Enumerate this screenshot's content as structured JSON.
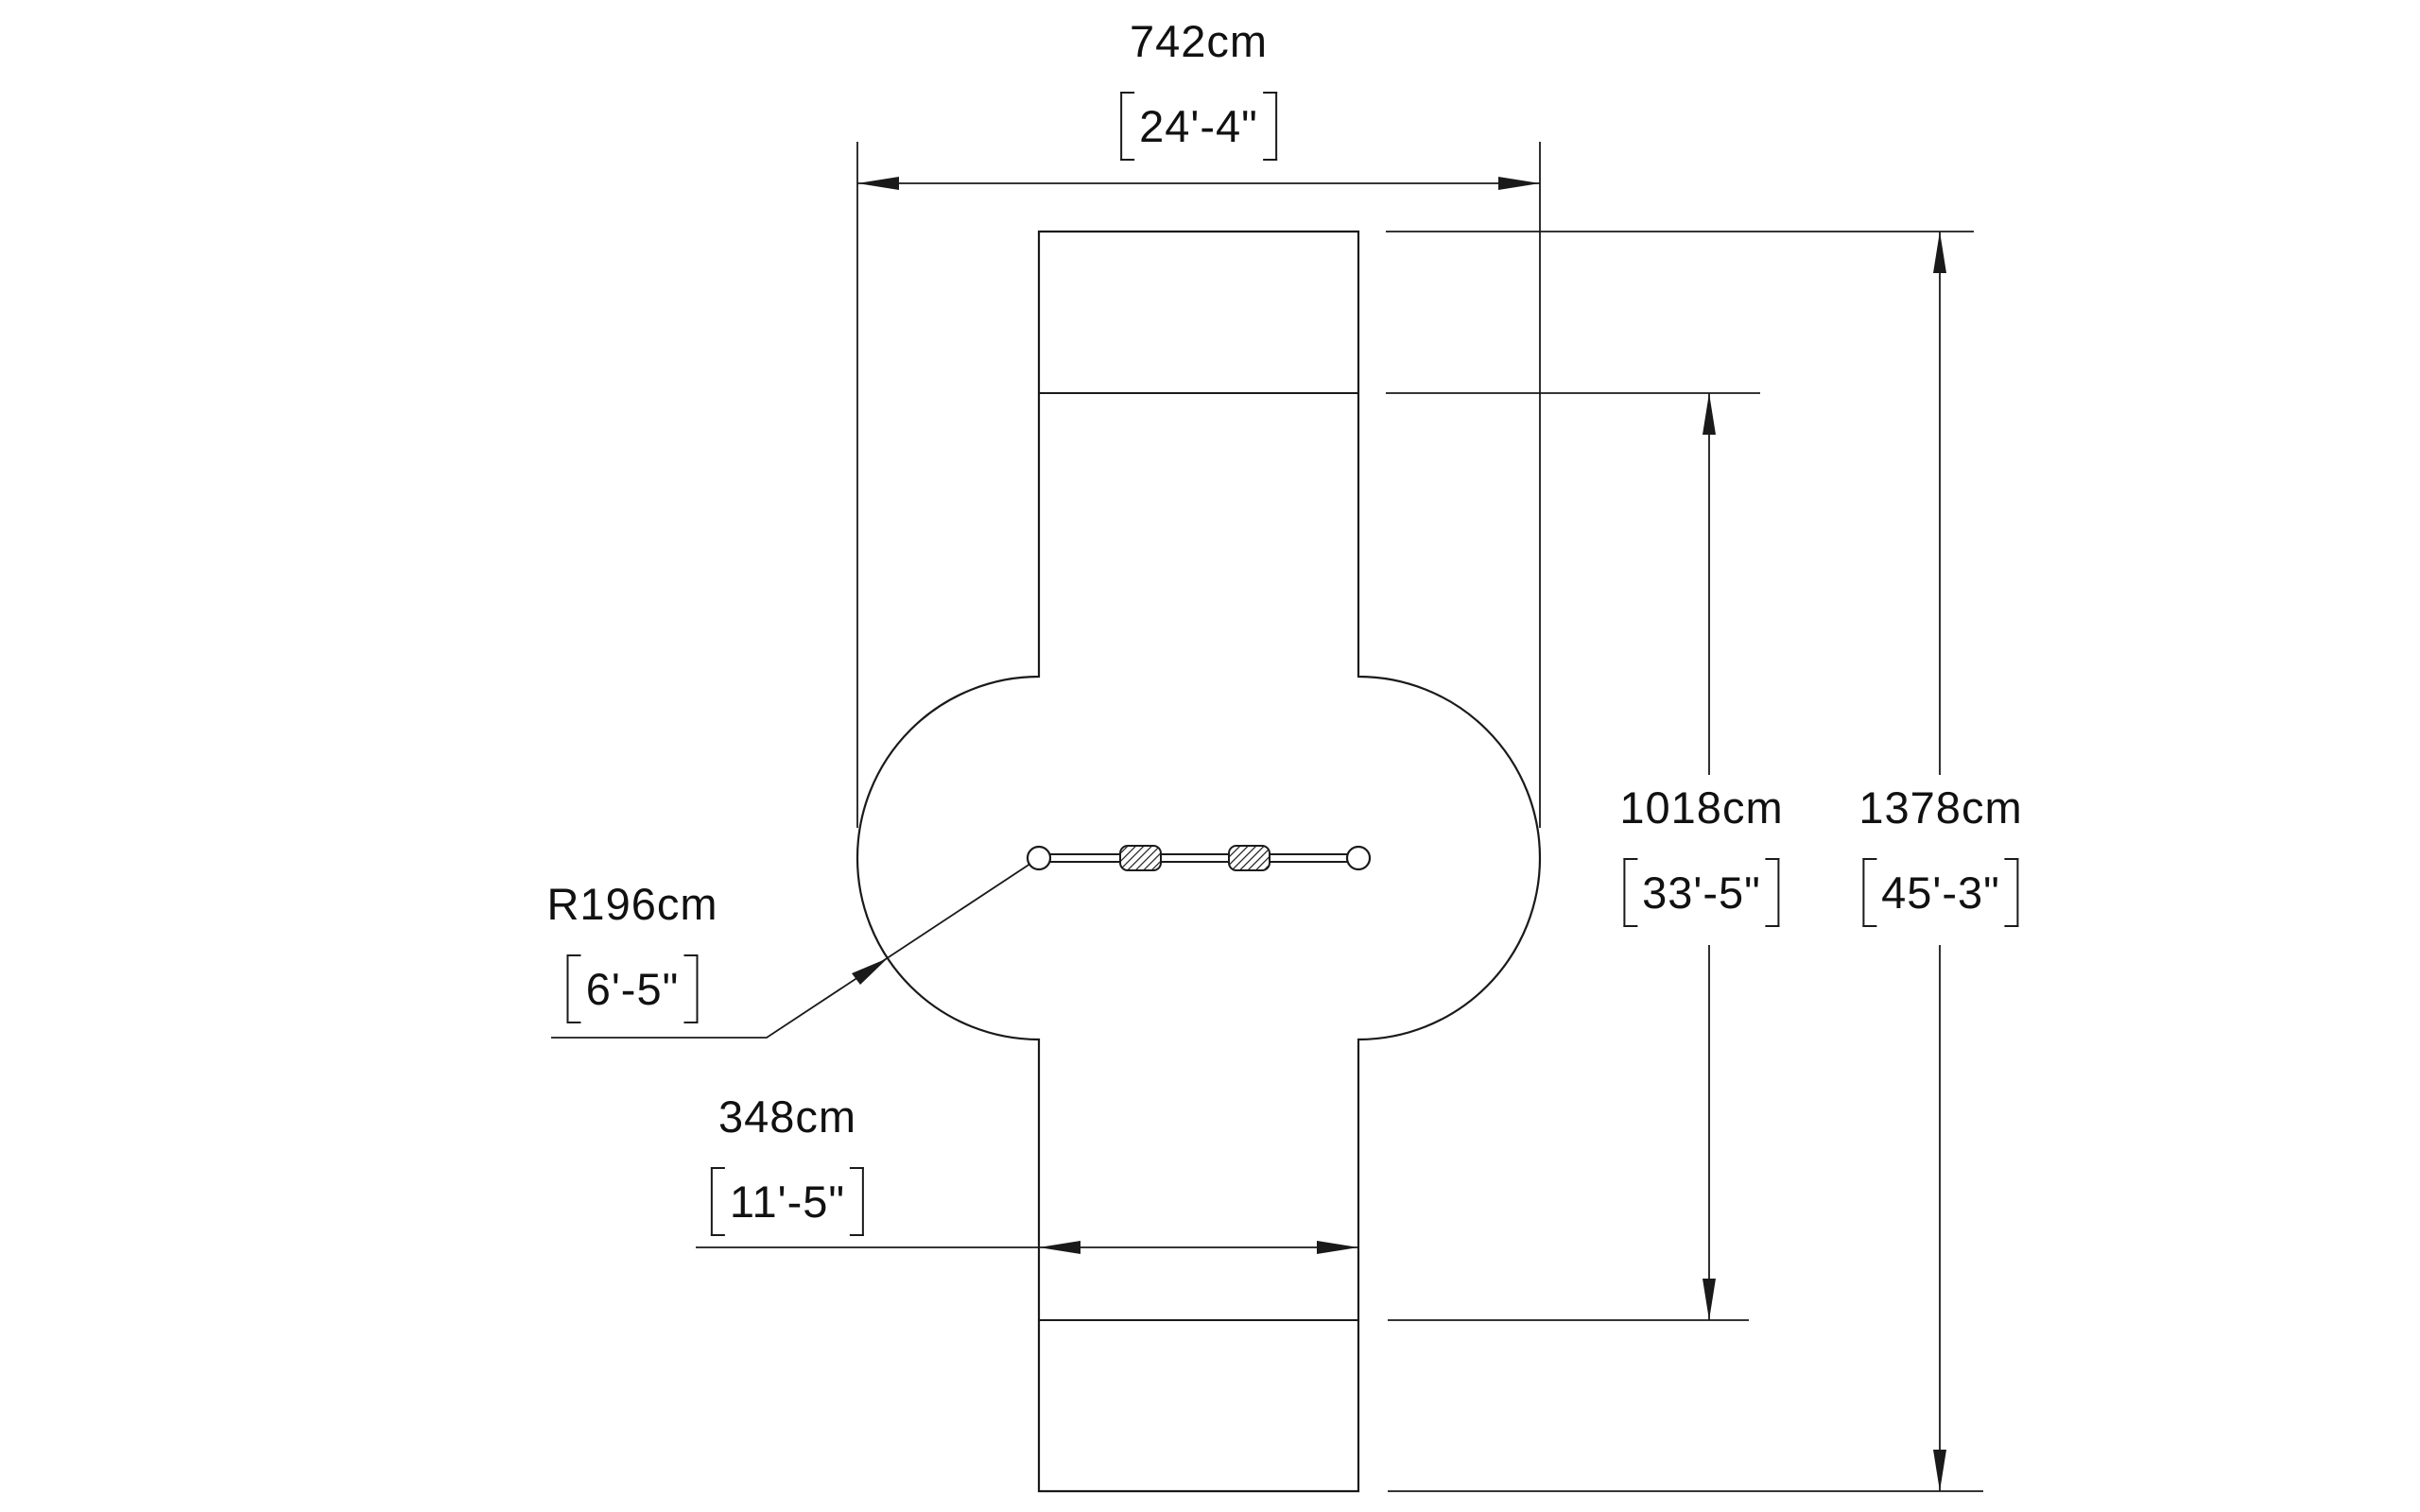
{
  "canvas": {
    "background": "#ffffff",
    "line_color": "#1a1a1a",
    "text_color": "#111111"
  },
  "drawing": {
    "dimensions": {
      "overall_width": {
        "metric": "742cm",
        "imperial": "24'-4\""
      },
      "inner_height": {
        "metric": "1018cm",
        "imperial": "33'-5\""
      },
      "overall_height": {
        "metric": "1378cm",
        "imperial": "45'-3\""
      },
      "bay_width": {
        "metric": "348cm",
        "imperial": "11'-5\""
      },
      "swing_radius": {
        "metric": "R196cm",
        "imperial": "6'-5\""
      }
    }
  }
}
